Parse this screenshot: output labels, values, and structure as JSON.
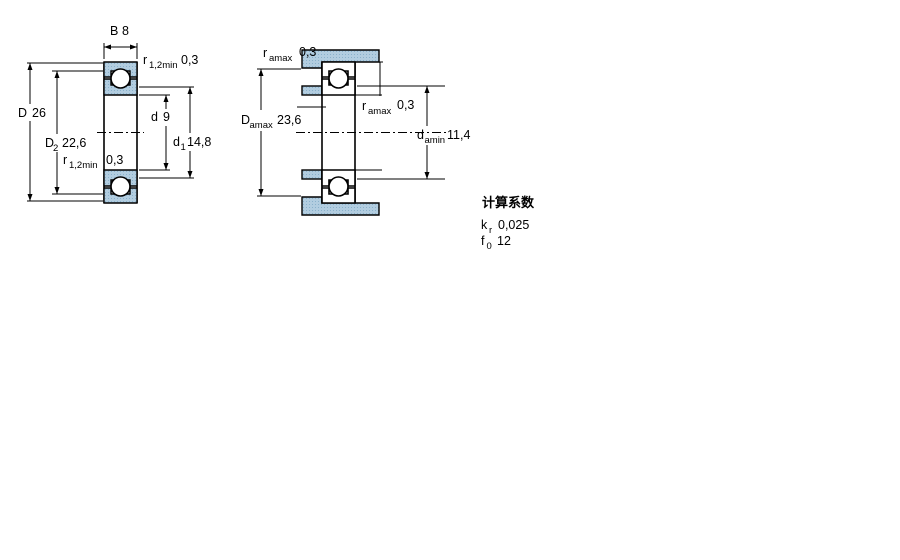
{
  "drawing": {
    "left": {
      "B": {
        "sym": "B",
        "val": "8"
      },
      "r_top": {
        "sym": "r",
        "sub": "1,2min",
        "val": "0,3"
      },
      "D": {
        "sym": "D",
        "val": "26"
      },
      "D2": {
        "sym": "D",
        "sub": "2",
        "val": "22,6"
      },
      "d": {
        "sym": "d",
        "val": "9"
      },
      "d1": {
        "sym": "d",
        "sub": "1",
        "val": "14,8"
      },
      "r_bottom": {
        "sym": "r",
        "sub": "1,2min",
        "val": "0,3"
      }
    },
    "right": {
      "ra_top": {
        "sym": "r",
        "sub": "amax",
        "val": "0,3"
      },
      "Da": {
        "sym": "D",
        "sub": "amax",
        "val": "23,6"
      },
      "ra_mid": {
        "sym": "r",
        "sub": "amax",
        "val": "0,3"
      },
      "da": {
        "sym": "d",
        "sub": "amin",
        "val": "11,4"
      }
    },
    "factors": {
      "title": "计算系数",
      "rows": [
        {
          "sym": "k",
          "sub": "r",
          "val": "0,025"
        },
        {
          "sym": "f",
          "sub": "0",
          "val": "12"
        }
      ]
    },
    "colors": {
      "steel_fill": "#b2cde0",
      "steel_dot": "#8ab1cb",
      "line": "#000000",
      "background": "#ffffff"
    }
  }
}
